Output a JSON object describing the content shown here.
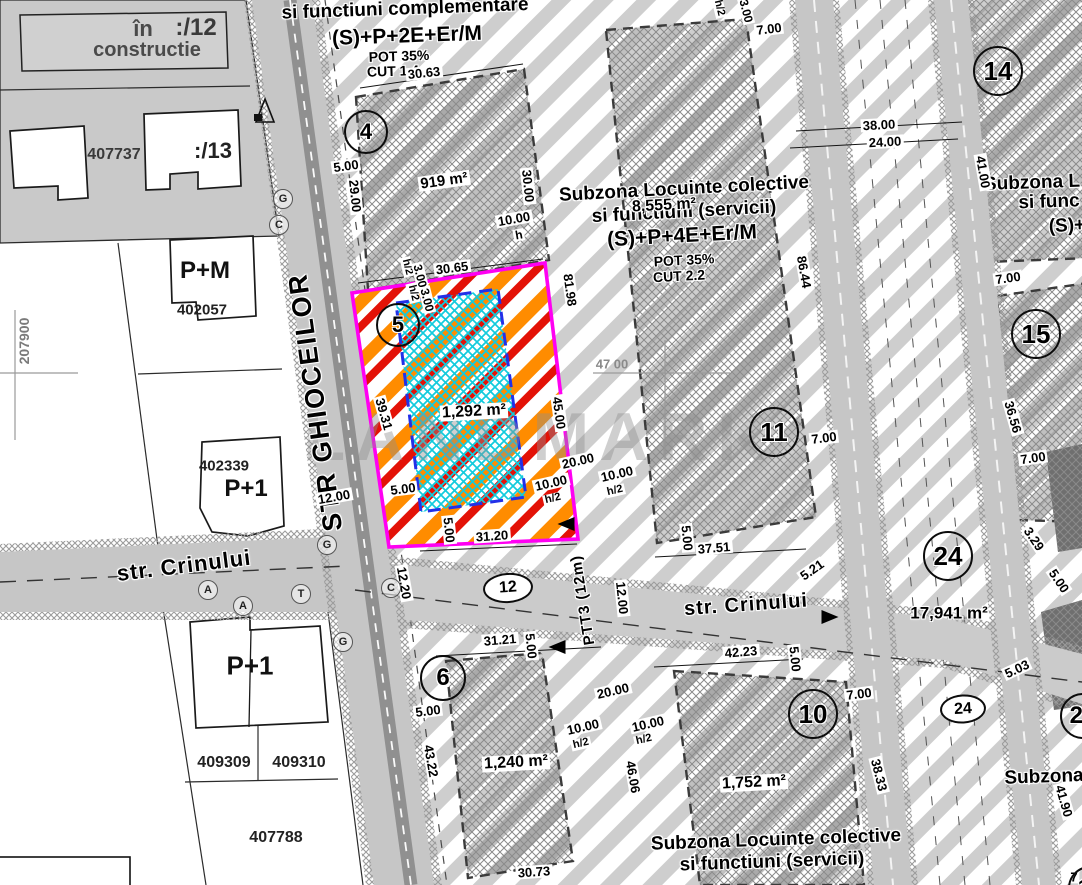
{
  "map": {
    "watermark": "LANDMARK",
    "street_labels": [
      {
        "n": "street-ghioceilor-label",
        "t": "STR GHIOCEILOR",
        "x": 316,
        "y": 402,
        "r": -98,
        "s": 27,
        "ls": 2
      },
      {
        "n": "street-crinului-west-label",
        "t": "str. Crinului",
        "x": 184,
        "y": 566,
        "r": -7,
        "s": 22
      },
      {
        "n": "street-crinului-east-label",
        "t": "str. Crinului",
        "x": 746,
        "y": 605,
        "r": -4,
        "s": 20
      },
      {
        "n": "street-ptt3-label",
        "t": "PTT3 (12m)",
        "x": 583,
        "y": 600,
        "r": -99,
        "s": 15
      }
    ],
    "zone_texts": [
      {
        "n": "zone-top-function",
        "t": "si functiuni complementare",
        "x": 405,
        "y": 9,
        "r": -2,
        "s": 19
      },
      {
        "n": "zone-top-regime",
        "t": "(S)+P+2E+Er/M",
        "x": 407,
        "y": 36,
        "r": -2,
        "s": 21
      },
      {
        "n": "zone-top-pot",
        "t": "POT 35%",
        "x": 399,
        "y": 56,
        "r": -2,
        "s": 14
      },
      {
        "n": "zone-top-cut",
        "t": "CUT 1.4",
        "x": 393,
        "y": 71,
        "r": -2,
        "s": 14
      },
      {
        "n": "zone-center-name-1",
        "t": "Subzona Locuinte colective",
        "x": 684,
        "y": 189,
        "r": -3,
        "s": 19
      },
      {
        "n": "zone-center-name-2",
        "t": "si functiuni (servicii)",
        "x": 684,
        "y": 212,
        "r": -3,
        "s": 19
      },
      {
        "n": "zone-center-regime",
        "t": "(S)+P+4E+Er/M",
        "x": 682,
        "y": 236,
        "r": -3,
        "s": 21
      },
      {
        "n": "zone-center-pot",
        "t": "POT 35%",
        "x": 684,
        "y": 260,
        "r": -3,
        "s": 14
      },
      {
        "n": "zone-center-cut",
        "t": "CUT 2.2",
        "x": 679,
        "y": 276,
        "r": -3,
        "s": 14
      },
      {
        "n": "zone-bottom-name-1",
        "t": "Subzona Locuinte colective",
        "x": 776,
        "y": 840,
        "r": -2,
        "s": 19
      },
      {
        "n": "zone-bottom-name-2",
        "t": "si functiuni (servicii)",
        "x": 772,
        "y": 862,
        "r": -2,
        "s": 19
      },
      {
        "n": "zone-right-top-name-1",
        "t": "Subzona L",
        "x": 1032,
        "y": 183,
        "r": -2,
        "s": 19
      },
      {
        "n": "zone-right-top-name-2",
        "t": "si func",
        "x": 1049,
        "y": 202,
        "r": -2,
        "s": 19
      },
      {
        "n": "zone-right-top-regime",
        "t": "(S)+",
        "x": 1067,
        "y": 226,
        "r": -2,
        "s": 19
      },
      {
        "n": "zone-right-bottom-name",
        "t": "Subzona",
        "x": 1044,
        "y": 777,
        "r": -2,
        "s": 19
      }
    ],
    "area_labels": [
      {
        "n": "area-parcel-4",
        "t": "919 m²",
        "x": 444,
        "y": 181,
        "r": -8,
        "s": 15
      },
      {
        "n": "area-parcel-5",
        "t": "1,292 m²",
        "x": 474,
        "y": 412,
        "r": -3,
        "s": 16
      },
      {
        "n": "area-zone-center",
        "t": "8,555 m²",
        "x": 664,
        "y": 206,
        "r": -3,
        "s": 16,
        "nb": 1
      },
      {
        "n": "area-parcel-6",
        "t": "1,240 m²",
        "x": 516,
        "y": 763,
        "r": -3,
        "s": 16
      },
      {
        "n": "area-parcel-10",
        "t": "1,752 m²",
        "x": 754,
        "y": 783,
        "r": -3,
        "s": 16
      },
      {
        "n": "area-zone-24",
        "t": "17,941 m²",
        "x": 949,
        "y": 613,
        "r": 0,
        "s": 17,
        "nb": 1
      }
    ],
    "dimensions": [
      {
        "t": "30.63",
        "x": 424,
        "y": 73,
        "r": -6
      },
      {
        "t": "5.00",
        "x": 346,
        "y": 166,
        "r": -8
      },
      {
        "t": "29.00",
        "x": 355,
        "y": 196,
        "r": 84
      },
      {
        "t": "30.00",
        "x": 528,
        "y": 186,
        "r": 84
      },
      {
        "t": "10.00",
        "x": 514,
        "y": 219,
        "r": -10
      },
      {
        "t": "h",
        "x": 519,
        "y": 235,
        "r": -10,
        "s": 12
      },
      {
        "t": "30.65",
        "x": 452,
        "y": 268,
        "r": -7
      },
      {
        "t": "h/2",
        "x": 407,
        "y": 267,
        "r": 76,
        "s": 11
      },
      {
        "t": "3.00",
        "x": 420,
        "y": 276,
        "r": 76,
        "s": 12
      },
      {
        "t": "h/2",
        "x": 413,
        "y": 293,
        "r": 76,
        "s": 11
      },
      {
        "t": "3.00",
        "x": 427,
        "y": 300,
        "r": 76,
        "s": 12
      },
      {
        "t": "81.98",
        "x": 570,
        "y": 290,
        "r": 82
      },
      {
        "t": "45.00",
        "x": 559,
        "y": 413,
        "r": 82
      },
      {
        "t": "39.31",
        "x": 384,
        "y": 414,
        "r": 74
      },
      {
        "t": "5.00",
        "x": 403,
        "y": 489,
        "r": -7
      },
      {
        "t": "5.00",
        "x": 449,
        "y": 530,
        "r": 84
      },
      {
        "t": "31.20",
        "x": 492,
        "y": 536,
        "r": -4
      },
      {
        "t": "20.00",
        "x": 578,
        "y": 461,
        "r": -13
      },
      {
        "t": "10.00",
        "x": 551,
        "y": 483,
        "r": -13
      },
      {
        "t": "h/2",
        "x": 553,
        "y": 499,
        "r": -13,
        "s": 11
      },
      {
        "t": "10.00",
        "x": 617,
        "y": 474,
        "r": -13
      },
      {
        "t": "h/2",
        "x": 615,
        "y": 491,
        "r": -13,
        "s": 11
      },
      {
        "t": "12.00",
        "x": 334,
        "y": 497,
        "r": -10
      },
      {
        "t": "12.20",
        "x": 404,
        "y": 583,
        "r": 80
      },
      {
        "t": "12.00",
        "x": 622,
        "y": 598,
        "r": 84
      },
      {
        "t": "5.00",
        "x": 687,
        "y": 538,
        "r": 84
      },
      {
        "t": "37.51",
        "x": 714,
        "y": 548,
        "r": -5
      },
      {
        "t": "5.21",
        "x": 812,
        "y": 570,
        "r": -35
      },
      {
        "t": "7.00",
        "x": 824,
        "y": 438,
        "r": -7
      },
      {
        "t": "31.21",
        "x": 500,
        "y": 640,
        "r": -5
      },
      {
        "t": "5.00",
        "x": 531,
        "y": 646,
        "r": 84
      },
      {
        "t": "5.00",
        "x": 428,
        "y": 711,
        "r": -7
      },
      {
        "t": "43.22",
        "x": 431,
        "y": 761,
        "r": 80
      },
      {
        "t": "20.00",
        "x": 613,
        "y": 691,
        "r": -13
      },
      {
        "t": "10.00",
        "x": 583,
        "y": 727,
        "r": -13
      },
      {
        "t": "h/2",
        "x": 581,
        "y": 744,
        "r": -13,
        "s": 11
      },
      {
        "t": "10.00",
        "x": 648,
        "y": 724,
        "r": -13
      },
      {
        "t": "h/2",
        "x": 644,
        "y": 740,
        "r": -13,
        "s": 11
      },
      {
        "t": "46.06",
        "x": 633,
        "y": 777,
        "r": 80
      },
      {
        "t": "30.73",
        "x": 534,
        "y": 872,
        "r": -4
      },
      {
        "t": "42.23",
        "x": 741,
        "y": 652,
        "r": -5
      },
      {
        "t": "5.00",
        "x": 795,
        "y": 659,
        "r": 84
      },
      {
        "t": "7.00",
        "x": 859,
        "y": 694,
        "r": -7
      },
      {
        "t": "38.33",
        "x": 879,
        "y": 775,
        "r": 76
      },
      {
        "t": "38.00",
        "x": 879,
        "y": 125,
        "r": -3
      },
      {
        "t": "24.00",
        "x": 885,
        "y": 142,
        "r": -3
      },
      {
        "t": "41.00",
        "x": 983,
        "y": 172,
        "r": 80
      },
      {
        "t": "7.00",
        "x": 1008,
        "y": 278,
        "r": -8
      },
      {
        "t": "36.56",
        "x": 1013,
        "y": 417,
        "r": 74
      },
      {
        "t": "7.00",
        "x": 1033,
        "y": 458,
        "r": -8
      },
      {
        "t": "3.29",
        "x": 1034,
        "y": 539,
        "r": 56
      },
      {
        "t": "5.00",
        "x": 1059,
        "y": 581,
        "r": 56
      },
      {
        "t": "5.03",
        "x": 1017,
        "y": 669,
        "r": -25
      },
      {
        "t": "41.90",
        "x": 1064,
        "y": 801,
        "r": 74
      },
      {
        "t": "86.44",
        "x": 804,
        "y": 272,
        "r": 80
      },
      {
        "t": "h/2",
        "x": 719,
        "y": 8,
        "r": 76,
        "s": 11
      },
      {
        "t": "3.00",
        "x": 746,
        "y": 11,
        "r": 76,
        "s": 12
      },
      {
        "t": "7.00",
        "x": 769,
        "y": 29,
        "r": -7
      },
      {
        "t": "7",
        "x": 1074,
        "y": 877,
        "r": 0
      }
    ],
    "parcel_ids": [
      {
        "n": "parcel-12-status-1",
        "t": "în",
        "x": 143,
        "y": 29,
        "s": 22,
        "c": "#4a4a4a"
      },
      {
        "n": "parcel-12-id",
        "t": ":/12",
        "x": 196,
        "y": 28,
        "s": 24,
        "c": "#3a3a3a"
      },
      {
        "n": "parcel-12-status-2",
        "t": "constructie",
        "x": 147,
        "y": 50,
        "s": 20,
        "c": "#4a4a4a"
      },
      {
        "n": "parcel-407737-id",
        "t": "407737",
        "x": 114,
        "y": 155,
        "s": 16,
        "c": "#3a3a3a"
      },
      {
        "n": "parcel-13-id",
        "t": ":/13",
        "x": 213,
        "y": 151,
        "s": 22,
        "c": "#222222"
      },
      {
        "n": "building-pm-label",
        "t": "P+M",
        "x": 205,
        "y": 271,
        "s": 24,
        "c": "#111111"
      },
      {
        "n": "parcel-402057-id",
        "t": "402057",
        "x": 202,
        "y": 310,
        "s": 15,
        "c": "#222222"
      },
      {
        "n": "parcel-402339-id",
        "t": "402339",
        "x": 224,
        "y": 466,
        "s": 15,
        "c": "#222222"
      },
      {
        "n": "building-p1-north-label",
        "t": "P+1",
        "x": 246,
        "y": 489,
        "s": 24,
        "c": "#111111"
      },
      {
        "n": "building-p1-south-label",
        "t": "P+1",
        "x": 250,
        "y": 666,
        "s": 26,
        "c": "#111111"
      },
      {
        "n": "parcel-409309-id",
        "t": "409309",
        "x": 224,
        "y": 763,
        "s": 16,
        "c": "#222222"
      },
      {
        "n": "parcel-409310-id",
        "t": "409310",
        "x": 299,
        "y": 763,
        "s": 16,
        "c": "#222222"
      },
      {
        "n": "parcel-407788-id",
        "t": "407788",
        "x": 276,
        "y": 838,
        "s": 16,
        "c": "#222222"
      }
    ],
    "grid_labels": [
      {
        "n": "grid-northing-label",
        "t": "207900",
        "x": 24,
        "y": 341,
        "r": -90,
        "s": 14,
        "c": "#7a7a7a"
      },
      {
        "n": "grid-easting-label",
        "t": "47 00",
        "x": 612,
        "y": 364,
        "r": 0,
        "s": 13,
        "c": "#8a8a8a"
      }
    ],
    "circles": [
      {
        "n": "parcel-number-4",
        "t": "4",
        "x": 366,
        "y": 132,
        "d": 40
      },
      {
        "n": "parcel-number-5",
        "t": "5",
        "x": 398,
        "y": 325,
        "d": 40
      },
      {
        "n": "parcel-number-6",
        "t": "6",
        "x": 443,
        "y": 678,
        "d": 42
      },
      {
        "n": "parcel-number-10",
        "t": "10",
        "x": 813,
        "y": 714,
        "d": 46
      },
      {
        "n": "parcel-number-11",
        "t": "11",
        "x": 774,
        "y": 432,
        "d": 46
      },
      {
        "n": "parcel-number-14",
        "t": "14",
        "x": 998,
        "y": 71,
        "d": 46
      },
      {
        "n": "parcel-number-15",
        "t": "15",
        "x": 1036,
        "y": 334,
        "d": 46
      },
      {
        "n": "parcel-number-24",
        "t": "24",
        "x": 948,
        "y": 556,
        "d": 46
      },
      {
        "n": "parcel-number-20",
        "t": "20",
        "x": 1083,
        "y": 716,
        "d": 42
      },
      {
        "n": "parcel-number-17",
        "t": "17",
        "x": 1090,
        "y": 888,
        "d": 40
      }
    ],
    "ellipses": [
      {
        "n": "road-number-12",
        "t": "12",
        "x": 508,
        "y": 588,
        "w": 46,
        "h": 26,
        "r": -4
      },
      {
        "n": "road-number-24",
        "t": "24",
        "x": 963,
        "y": 709,
        "w": 42,
        "h": 25,
        "r": -3
      }
    ],
    "markers": [
      {
        "n": "utility-marker-g",
        "t": "G",
        "x": 283,
        "y": 199
      },
      {
        "n": "utility-marker-c",
        "t": "C",
        "x": 279,
        "y": 225
      },
      {
        "n": "utility-marker-g",
        "t": "G",
        "x": 327,
        "y": 545
      },
      {
        "n": "utility-marker-g",
        "t": "G",
        "x": 343,
        "y": 642
      },
      {
        "n": "utility-marker-t",
        "t": "T",
        "x": 301,
        "y": 594
      },
      {
        "n": "utility-marker-a",
        "t": "A",
        "x": 208,
        "y": 590
      },
      {
        "n": "utility-marker-a",
        "t": "A",
        "x": 243,
        "y": 606
      },
      {
        "n": "utility-marker-c",
        "t": "C",
        "x": 391,
        "y": 588
      }
    ],
    "arrows": [
      {
        "n": "leader-arrow-west",
        "x": 566,
        "y": 524,
        "r": 0
      },
      {
        "n": "leader-arrow-west-2",
        "x": 557,
        "y": 647,
        "r": 0
      },
      {
        "n": "leader-arrow-east",
        "x": 830,
        "y": 617,
        "r": 180
      }
    ]
  }
}
